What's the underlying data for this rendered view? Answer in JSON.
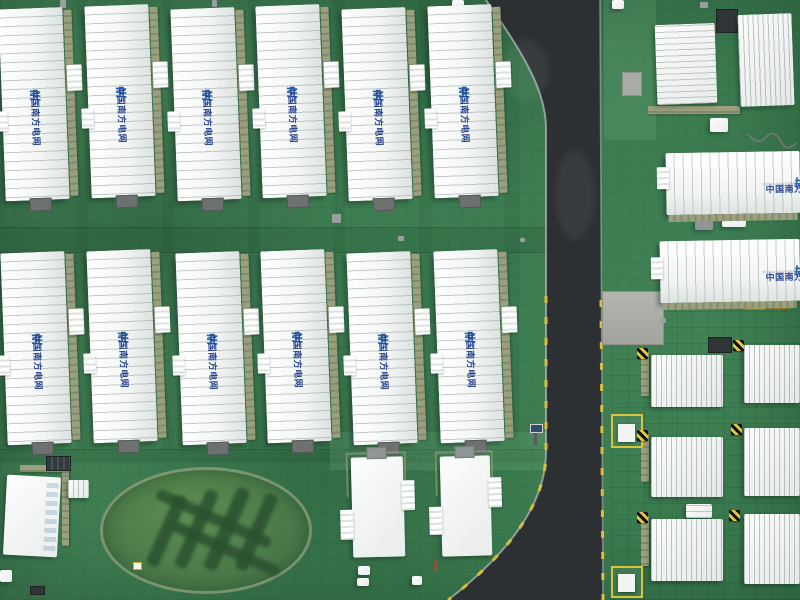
{
  "meta": {
    "scene_title": "Aerial view of a China Southern Power Grid battery energy storage station"
  },
  "branding": {
    "logo_icon": "csg-logo-icon",
    "name_cn": "中国南方电网",
    "name_en": "CHINA SOUTHERN POWER GRID",
    "logo_color": "#2061ac",
    "text_color": "#2b4690"
  },
  "palette": {
    "turf_green": "#3e7d52",
    "turf_dark_band": "#2f6a45",
    "road_asphalt": "#2c3033",
    "container_white": "#f4f6f5",
    "walkway_tan": "#9aa07f",
    "curb_marking_yellow": "#d9bd3e",
    "hazard_yellow": "#e7c83f",
    "hazard_black": "#121212",
    "hedge_dark_green": "#2c5130",
    "concrete_gray": "#a9aba5"
  },
  "scene": {
    "ground": "green synthetic turf with tile seams",
    "road": "asphalt road entering at top center, running vertically and flaring out at the bottom left corner, yellow dashed curb markings along both edges",
    "garden": "oval hedge garden, dark shrubs trimmed in diagonal stripes echoing the grid logo",
    "structures": {
      "branded_container_rows_left": [
        6,
        6
      ],
      "branded_containers_right": 2,
      "rooftop_unit_containers_top_right": 2,
      "cube_units_bottom_right": 6,
      "auxiliary_buildings_bottom": 3,
      "yellow_bordered_equipment_pads": 2
    }
  }
}
